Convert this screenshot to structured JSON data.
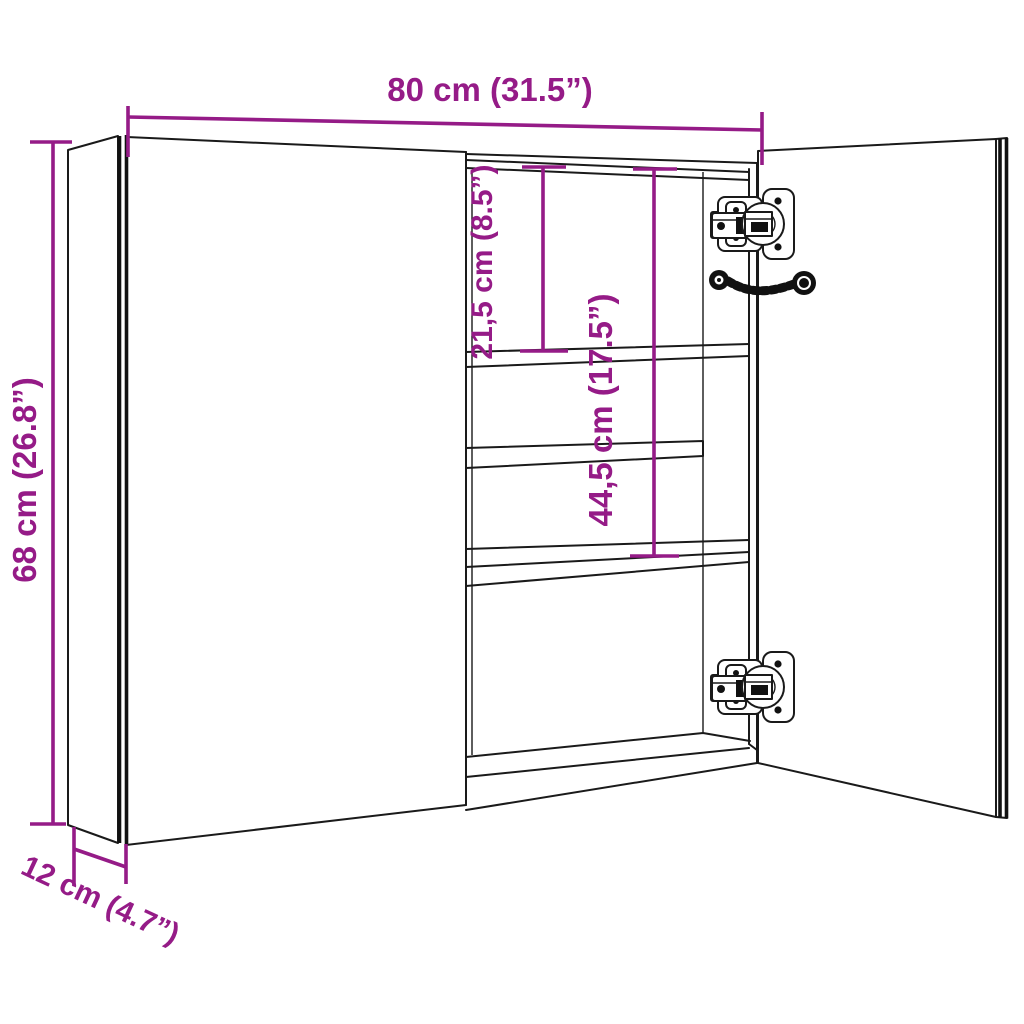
{
  "diagram_title": "Mirror cabinet dimension diagram",
  "colors": {
    "dimension_accent": "#951B87",
    "line_art": "#1a1a1a",
    "background": "#ffffff"
  },
  "dimensions": {
    "width": "80 cm (31.5”)",
    "height": "68 cm (26.8”)",
    "depth": "12 cm (4.7”)",
    "upper_shelf_gap": "21,5 cm (8.5”)",
    "lower_shelf_gap": "44,5 cm (17.5”)"
  }
}
